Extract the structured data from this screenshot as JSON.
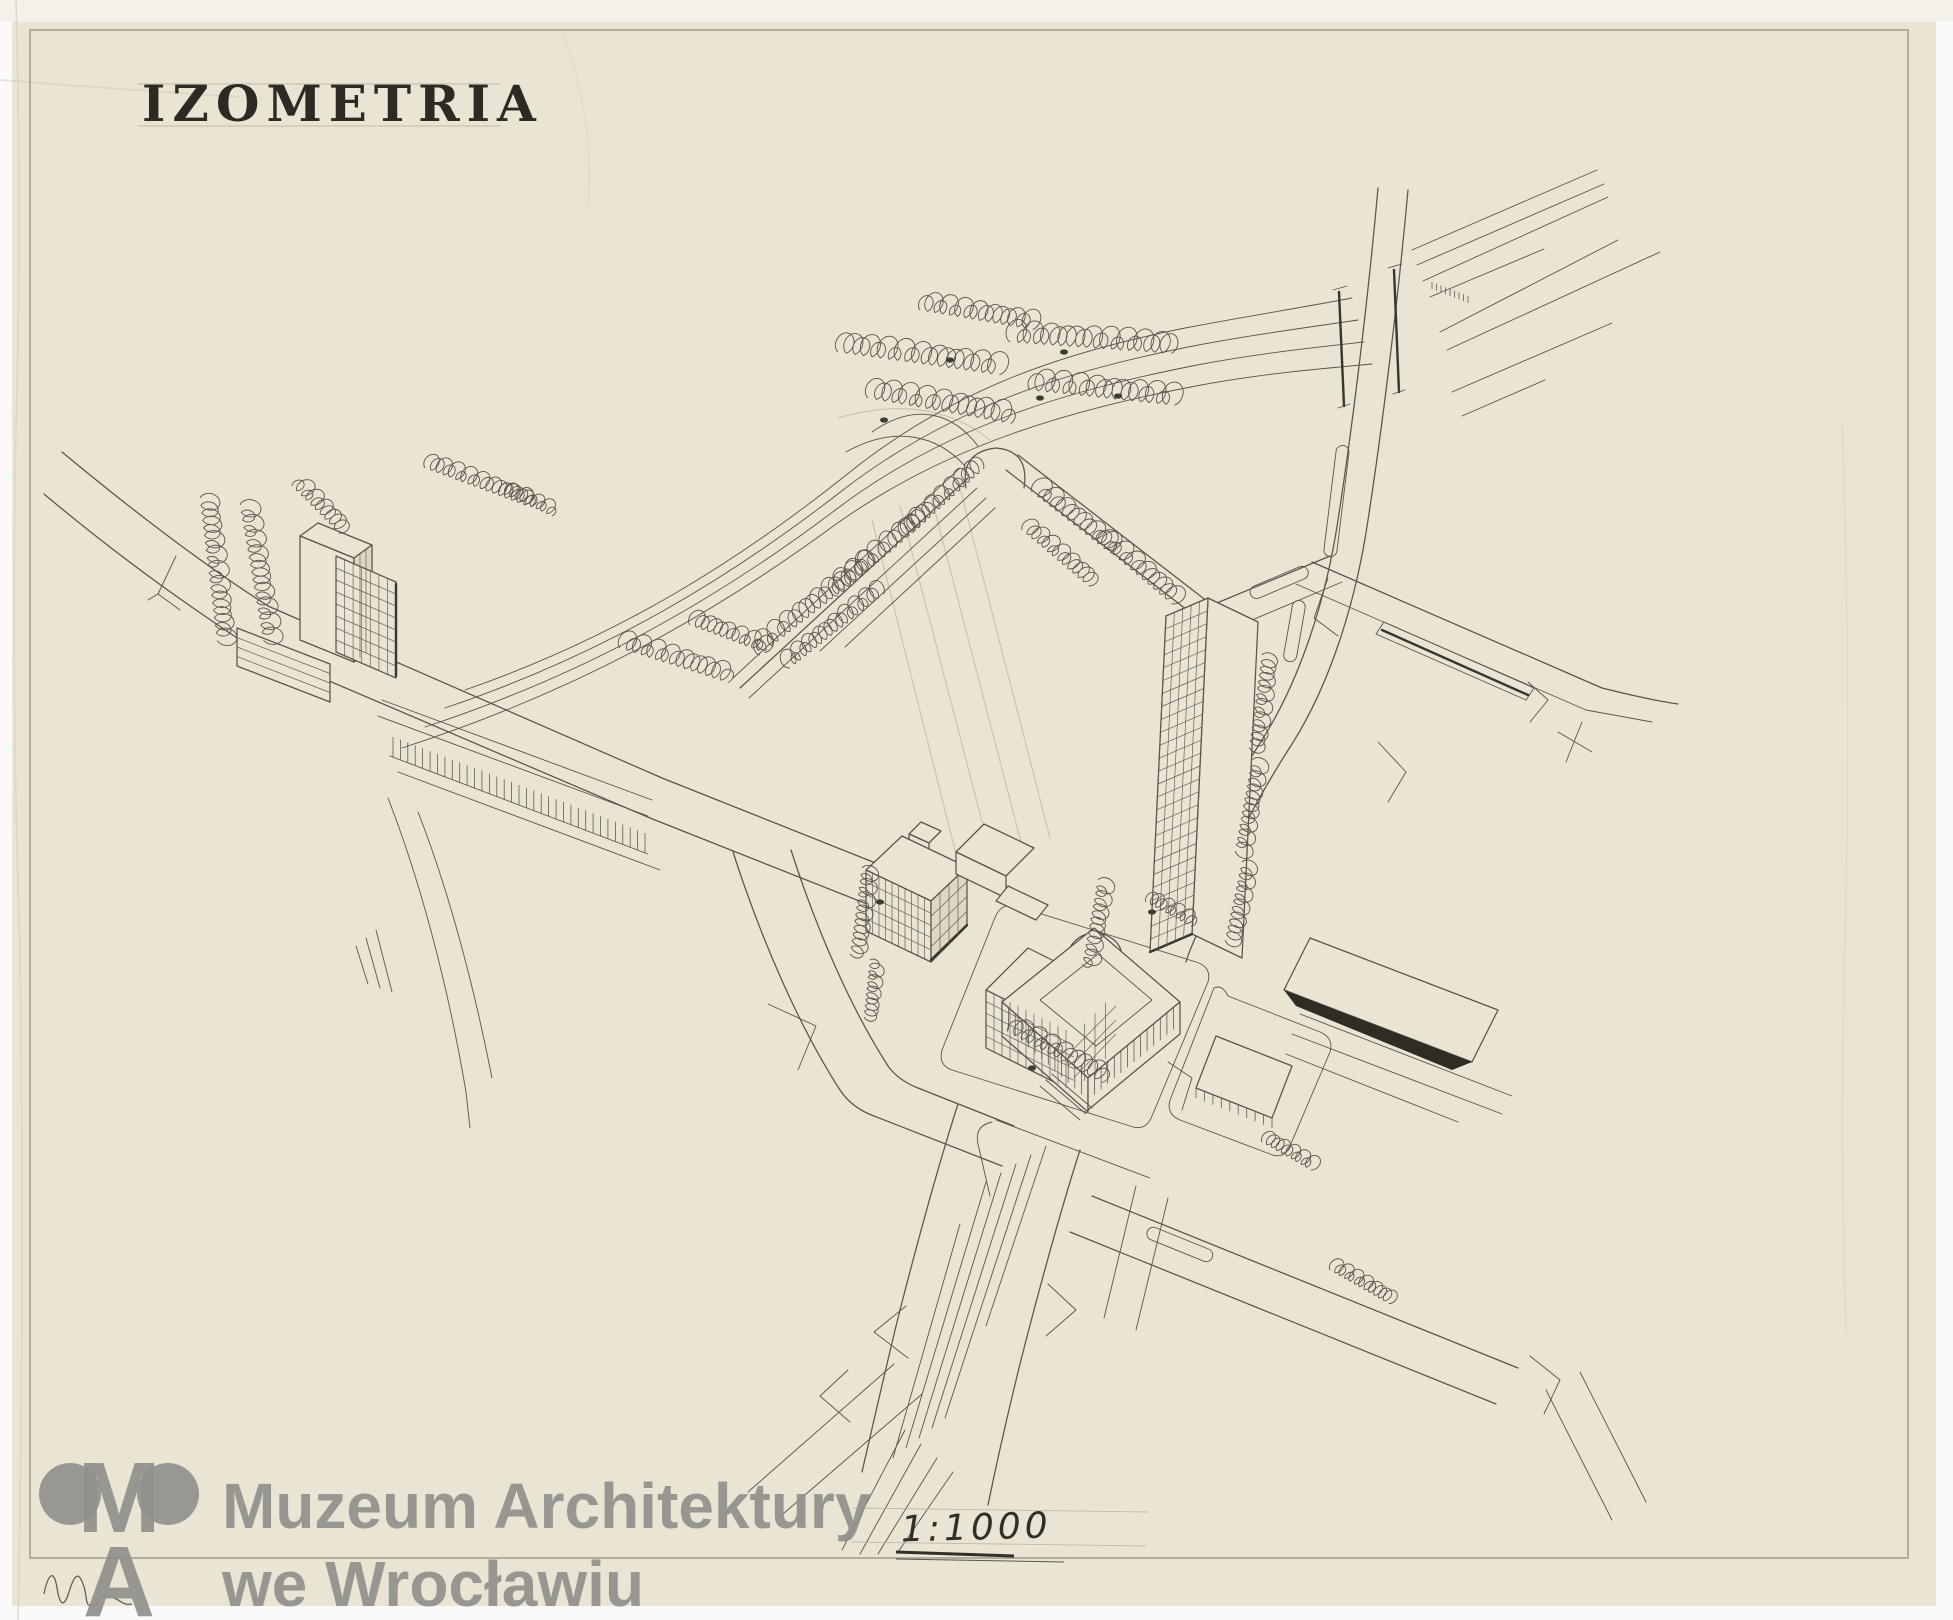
{
  "artwork": {
    "title": "IZOMETRIA",
    "scale_label": "1:1000"
  },
  "watermark": {
    "logo": "ma-monogram",
    "logo_m": "M",
    "logo_a": "A",
    "line1": "Muzeum Architektury",
    "line2": "we Wrocławiu"
  },
  "colors": {
    "paper": "#eae4d4",
    "backing": "#fafaf8",
    "ink": "#5a544a",
    "ink_dark": "#2f2b25",
    "pencil_faint": "#a89f8c",
    "watermark_gray": "#90908c"
  }
}
